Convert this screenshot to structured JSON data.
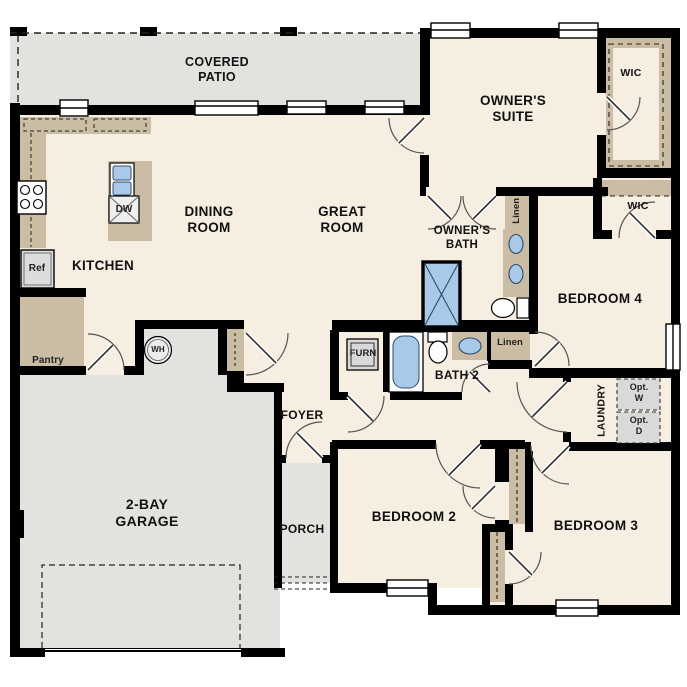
{
  "plan_type": "single-story residential floor plan",
  "palette": {
    "wall": "#000000",
    "interior_floor": "#f6eee1",
    "outdoor_floor": "#e3e2df",
    "casework_tan": "#cabda4",
    "fixture_blue": "#a9c9e9",
    "appliance_gray": "#dcdcdc"
  },
  "labels": {
    "covered_patio": "COVERED PATIO",
    "owners_suite": "OWNER'S SUITE",
    "wic1": "WIC",
    "wic2": "WIC",
    "dining_room": "DINING ROOM",
    "great_room": "GREAT ROOM",
    "owners_bath": "OWNER'S BATH",
    "linen1": "Linen",
    "linen2": "Linen",
    "bedroom4": "BEDROOM 4",
    "kitchen": "KITCHEN",
    "ref": "Ref",
    "dw": "DW",
    "pantry": "Pantry",
    "wh": "WH",
    "furn": "FURN",
    "bath2": "BATH 2",
    "laundry": "LAUNDRY",
    "opt_w": "Opt. W",
    "opt_d": "Opt. D",
    "foyer": "FOYER",
    "garage": "2-BAY GARAGE",
    "porch": "PORCH",
    "bedroom2": "BEDROOM 2",
    "bedroom3": "BEDROOM 3"
  }
}
